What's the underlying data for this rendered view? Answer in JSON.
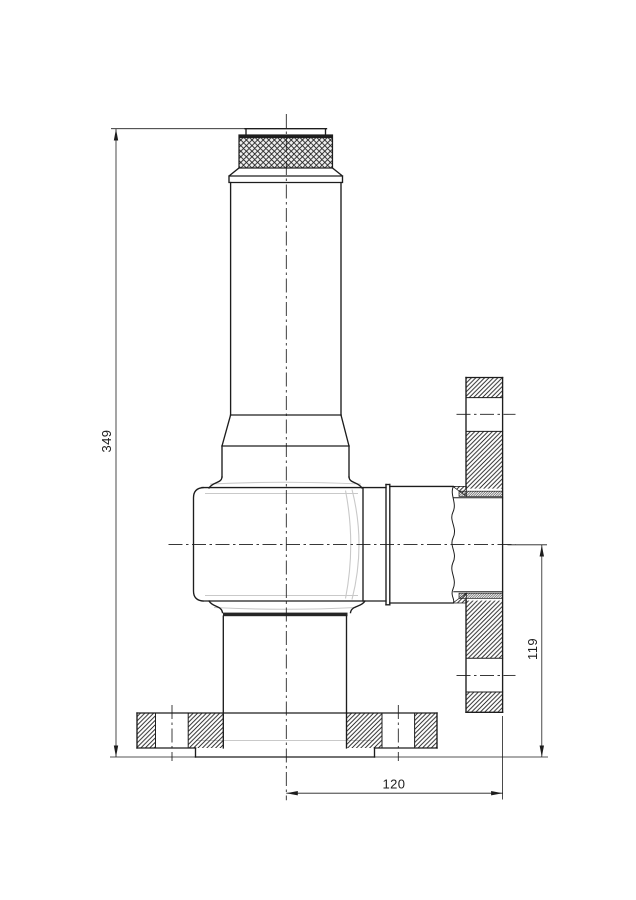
{
  "drawing": {
    "kind": "technical-section-drawing",
    "dimensions": {
      "overall_height": {
        "label": "349",
        "orientation": "vertical"
      },
      "outlet_height": {
        "label": "119",
        "orientation": "vertical"
      },
      "outlet_offset": {
        "label": "120",
        "orientation": "horizontal"
      }
    },
    "colors": {
      "line": "#1d1d1d",
      "faint": "#c9c9c9",
      "background": "#ffffff"
    }
  }
}
